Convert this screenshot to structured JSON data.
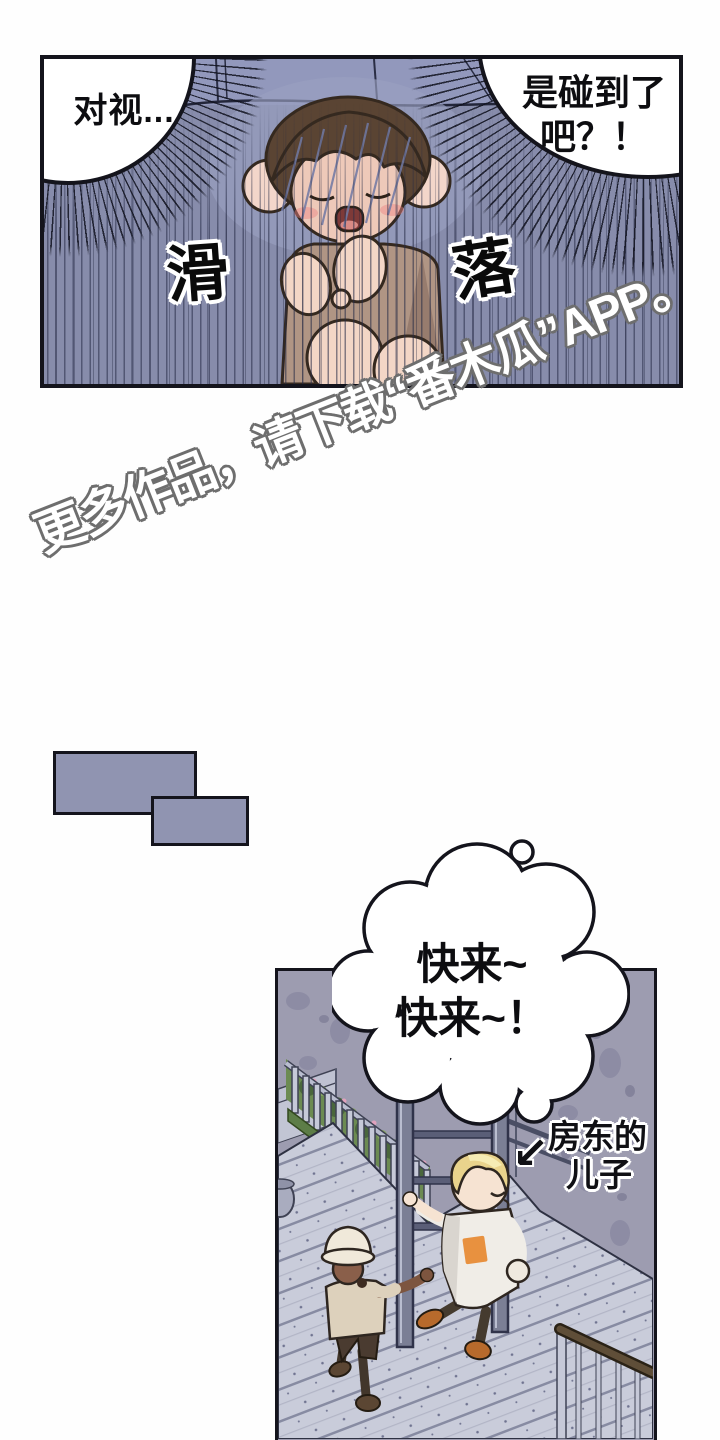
{
  "panel1": {
    "bubble_left": {
      "text": "对视..."
    },
    "bubble_right": {
      "line1": "是碰到了",
      "line2": "吧？！"
    },
    "sfx_left": "滑",
    "sfx_right": "落"
  },
  "watermark": {
    "text": "更多作品，请下载“番木瓜”APP。"
  },
  "panel2": {
    "bubble": {
      "line1": "快来~",
      "line2": "快来~！"
    },
    "label": {
      "line1": "房东的",
      "line2": "儿子"
    },
    "arrow_glyph": "↙"
  },
  "palette": {
    "panel1_wall": "#878cab",
    "panel1_wall_top": "#9298bc",
    "streak_line": "#262b46",
    "rect_fill": "#9094b1",
    "panel2_wall": "#9d9cb0",
    "deck": "#c9ccda",
    "foliage_green": "#6c8b52",
    "gate_gray": "#7b7f95",
    "hair_brown": "#5a4433",
    "hair_blonde": "#e9d38c",
    "shirt_tan": "#b09584",
    "shirt_white": "#f0ede7",
    "patch_orange": "#e8913f",
    "shoe_orange": "#b76a2c",
    "skin_light": "#f3d6c6",
    "skin_dark": "#8a5f4a",
    "handrail_brown": "#5f4e38",
    "outline_black": "#14141c"
  }
}
